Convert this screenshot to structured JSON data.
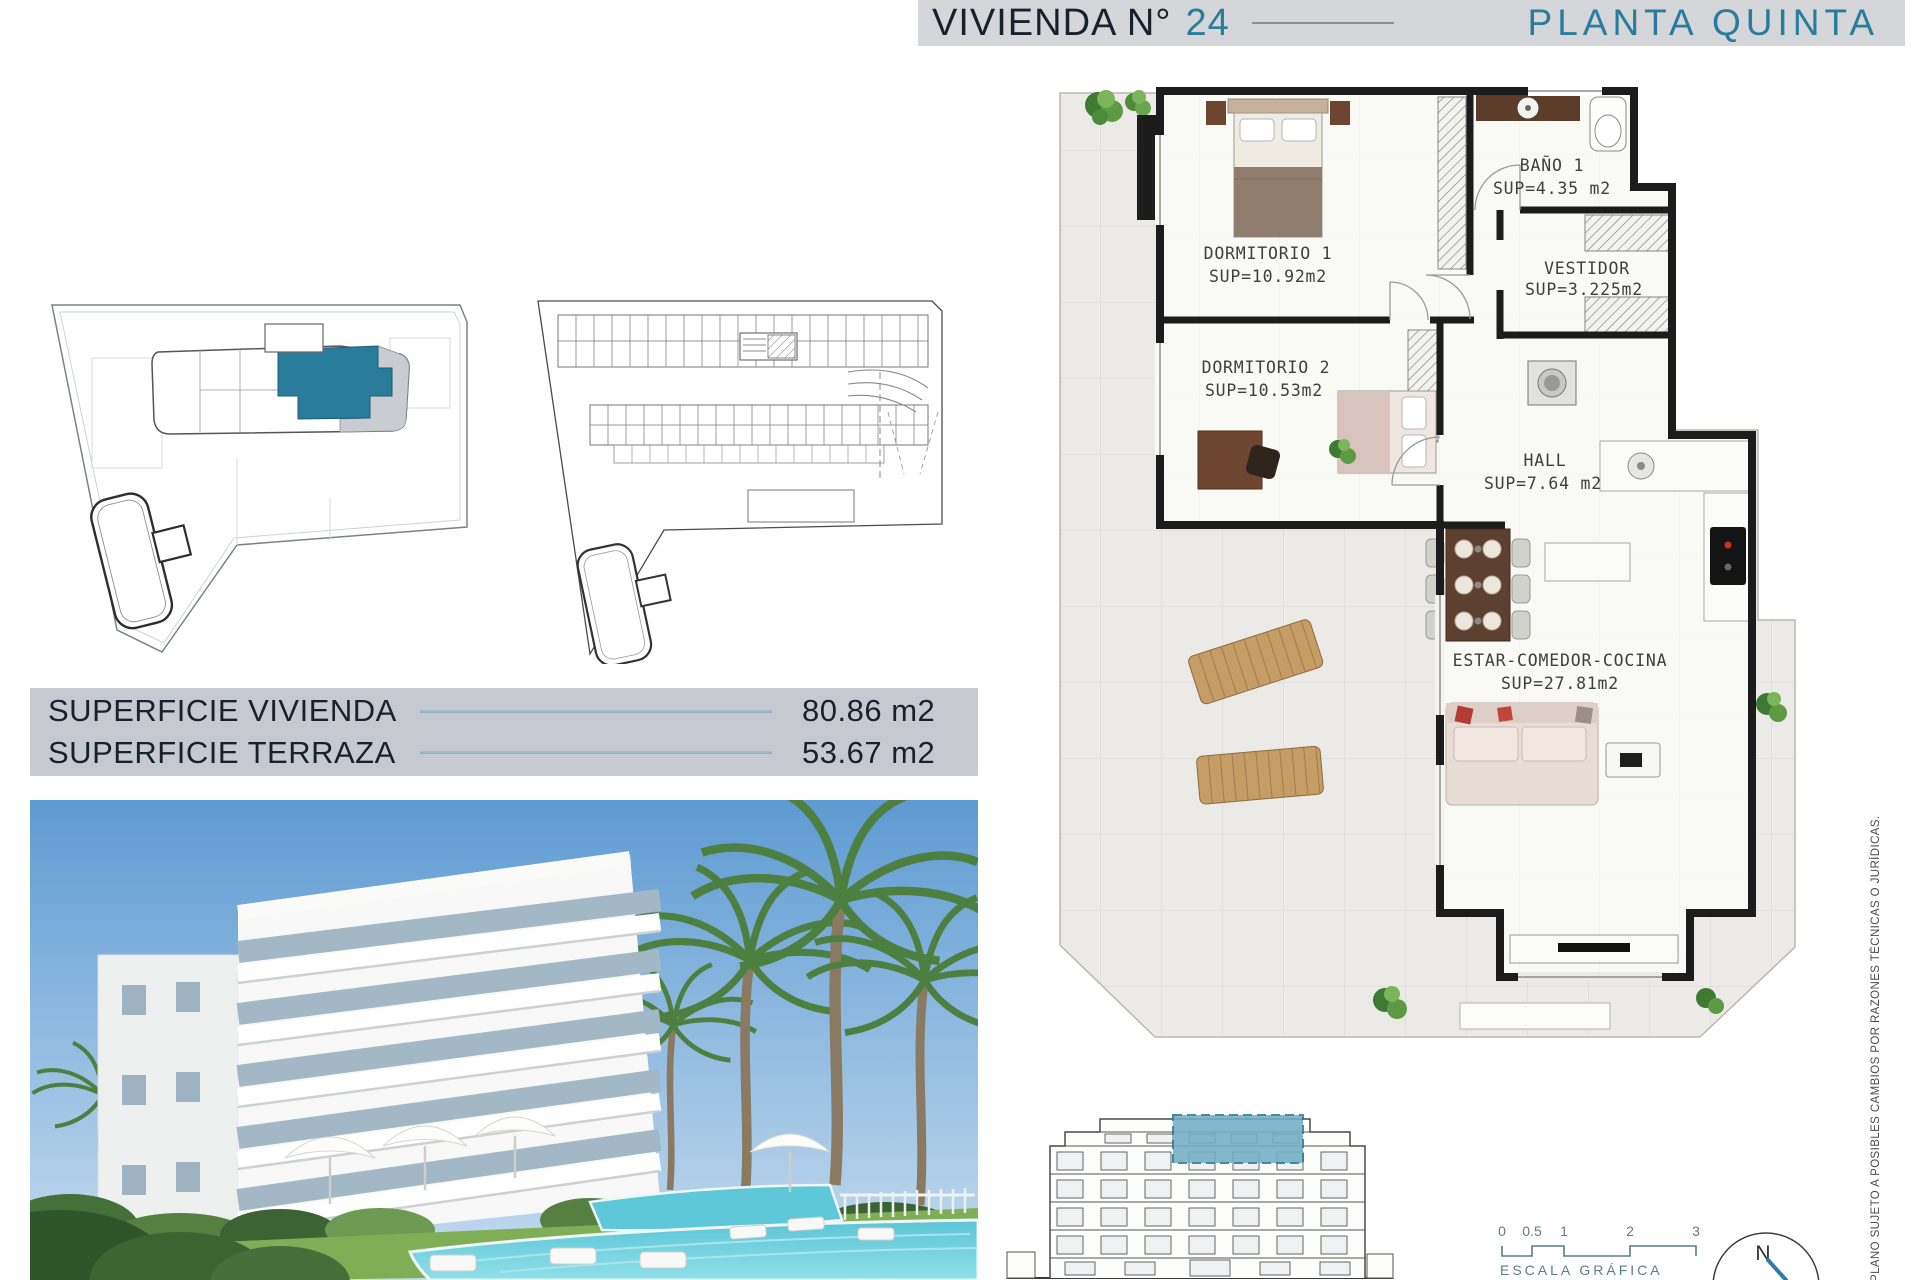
{
  "header": {
    "title_prefix": "VIVIENDA N°",
    "unit_number": "24",
    "floor_label": "PLANTA QUINTA"
  },
  "floor_plan": {
    "rooms": [
      {
        "name": "DORMITORIO 1",
        "sup": "SUP=10.92m2"
      },
      {
        "name": "BAÑO 1",
        "sup": "SUP=4.35 m2"
      },
      {
        "name": "VESTIDOR",
        "sup": "SUP=3.225m2"
      },
      {
        "name": "DORMITORIO 2",
        "sup": "SUP=10.53m2"
      },
      {
        "name": "HALL",
        "sup": "SUP=7.64 m2"
      },
      {
        "name": "ESTAR-COMEDOR-COCINA",
        "sup": "SUP=27.81m2"
      }
    ]
  },
  "surface_table": {
    "rows": [
      {
        "label": "SUPERFICIE VIVIENDA",
        "value": "80.86 m2"
      },
      {
        "label": "SUPERFICIE TERRAZA",
        "value": "53.67 m2"
      }
    ]
  },
  "scale_bar": {
    "ticks": [
      "0",
      "0.5",
      "1",
      "2",
      "3"
    ],
    "label": "ESCALA GRÁFICA"
  },
  "compass": {
    "north_label": "N"
  },
  "disclaimer": "PLANO SUJETO A POSIBLES CAMBIOS POR RAZONES TÉCNICAS O JURÍDICAS.",
  "colors": {
    "teal": "#2a7c9b",
    "navy": "#18222c",
    "header_bg": "#d4d6d9",
    "table_bg": "#c6cad0",
    "elevation_highlight": "#74aec6"
  }
}
